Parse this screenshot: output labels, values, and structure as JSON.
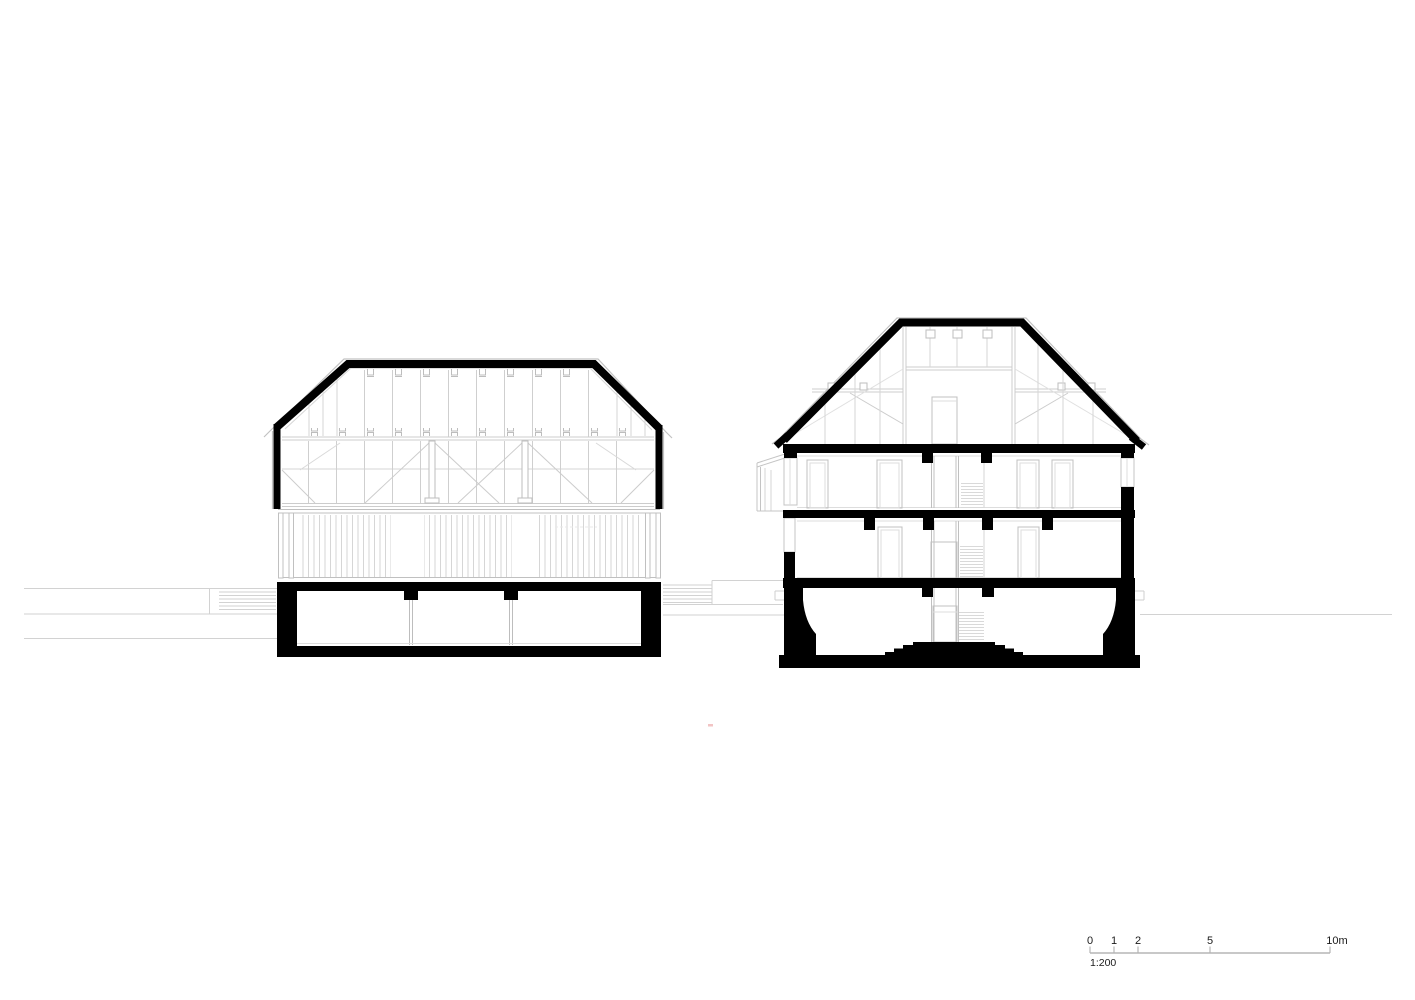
{
  "scale_bar": {
    "tick_labels": [
      "0",
      "1",
      "2",
      "5",
      "10m"
    ],
    "ratio_label": "1:200",
    "meters": [
      0,
      1,
      2,
      5,
      10
    ]
  },
  "colors": {
    "ink": "#000000",
    "line_outer": "#c2c2c2",
    "line_framing": "#cccccc",
    "line_faint": "#dddddd",
    "terrain": "#d2d2d2",
    "slat": "#d6d6d6",
    "background": "#ffffff",
    "tiny_mark": "#f2c4c4"
  }
}
